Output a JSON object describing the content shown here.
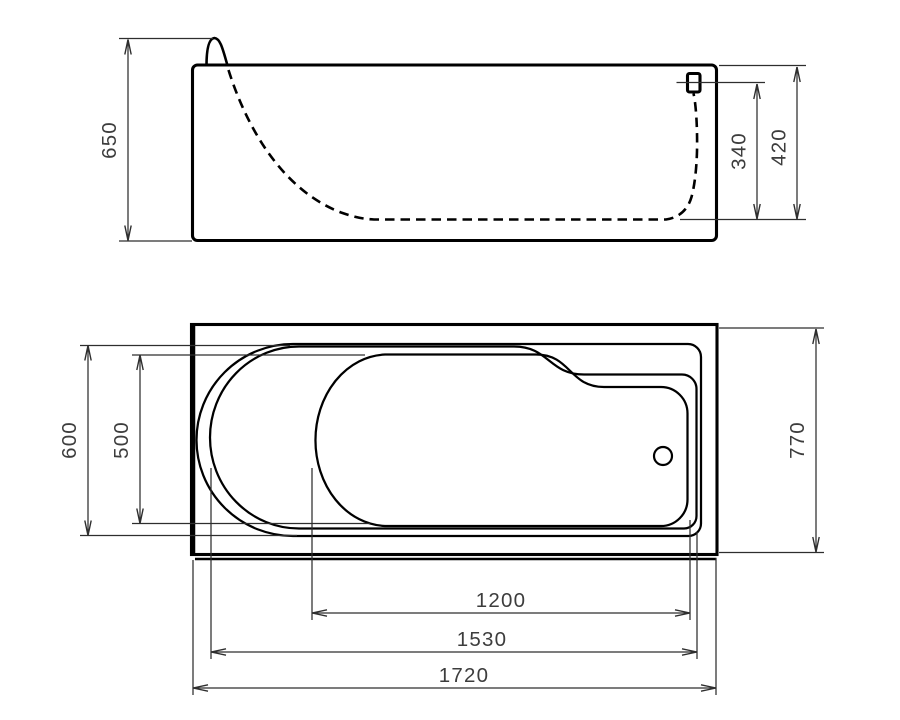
{
  "drawing": {
    "description": "Bathtub technical drawing with two orthographic views (side elevation above, top plan below), dimensioned in millimetres",
    "background": "#ffffff"
  },
  "colors": {
    "outline": "#000000",
    "dimension_line": "#2e2e2e",
    "dimension_text": "#3d3d3d"
  },
  "views": {
    "side_elevation": {
      "dimensions": {
        "total_height": "650",
        "overflow_to_floor": "340",
        "rim_to_floor": "420"
      }
    },
    "top_plan": {
      "dimensions": {
        "head_end_outer_width": "600",
        "head_end_inner_width": "500",
        "overall_width": "770",
        "floor_length": "1200",
        "basin_opening_length": "1530",
        "overall_length": "1720"
      }
    }
  }
}
